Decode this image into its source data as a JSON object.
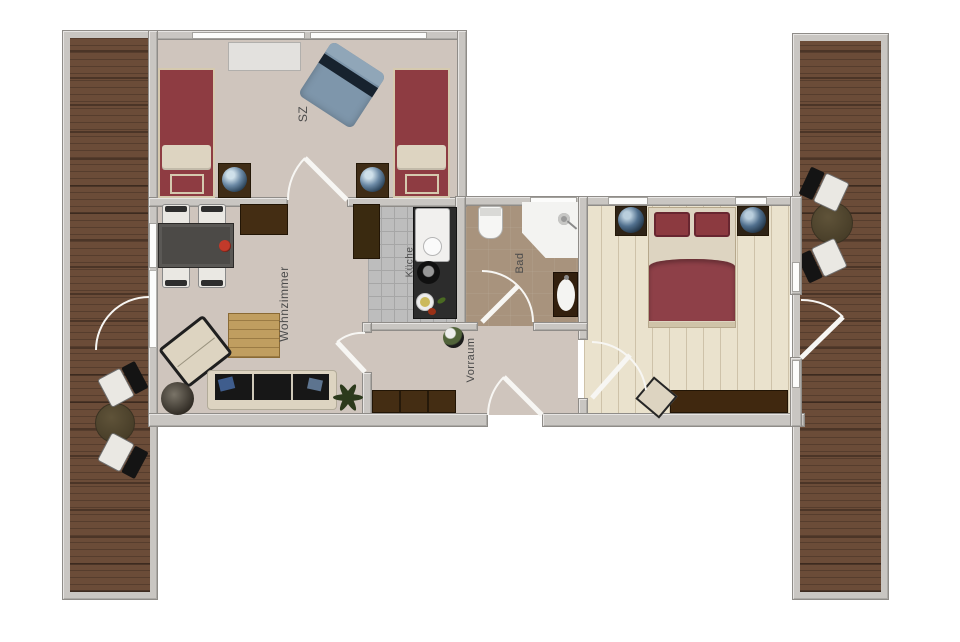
{
  "canvas": {
    "width": 960,
    "height": 642,
    "background": "#ffffff"
  },
  "rooms": [
    {
      "id": "sz",
      "label": "SZ"
    },
    {
      "id": "wohnzimmer",
      "label": "Wohnzimmer"
    },
    {
      "id": "kueche",
      "label": "Küche"
    },
    {
      "id": "bad",
      "label": "Bad"
    },
    {
      "id": "vorraum",
      "label": "Vorraum"
    }
  ],
  "colors": {
    "wall": "#c9c6c2",
    "wall-edge": "#8f8c88",
    "window": "#fcfcfb",
    "floor-main": "#cfc5bd",
    "floor-tile": "#bdbdbd",
    "tile-line": "#a6a6a6",
    "floor-bath": "#a8937d",
    "floor-plank": "#eae2cd",
    "deck-wood": "#6b4c38",
    "bed-maroon": "#8e3c42",
    "linen": "#ddd4c1",
    "furn-dark": "#442d13",
    "chair-white": "#eae8e3",
    "armchair-blue": "#7e96ab",
    "lamp-blue": "#51708e",
    "patio-table": "#5f5339",
    "coffee-wood": "#c09e60",
    "plant-green": "#2c3a1c",
    "label": "#4b4b4b"
  }
}
